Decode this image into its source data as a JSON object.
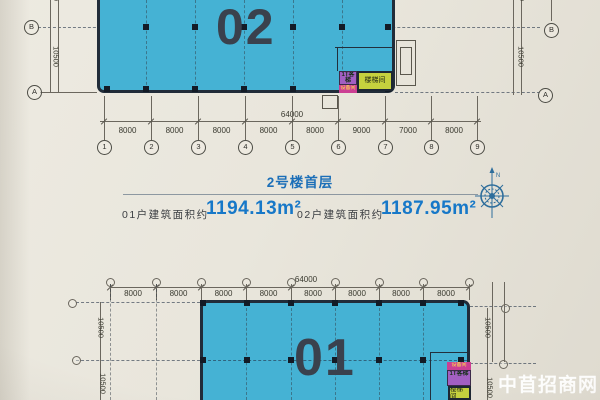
{
  "watermark": {
    "text": "中苜招商网"
  },
  "info": {
    "title": "2号楼首层",
    "areas": [
      {
        "label": "01户建筑面积约",
        "value": "1194.13m²"
      },
      {
        "label": "02户建筑面积约",
        "value": "1187.95m²"
      }
    ]
  },
  "compass": {
    "north_label": "N"
  },
  "plan_top": {
    "unit_label": "02",
    "total_dim": "64000",
    "segment_dims": [
      "8000",
      "8000",
      "8000",
      "8000",
      "8000",
      "9000",
      "7000",
      "8000"
    ],
    "grid_bubbles": [
      "1",
      "2",
      "3",
      "4",
      "5",
      "6",
      "7",
      "8",
      "9"
    ],
    "row_bubbles_left": [
      "B",
      "A"
    ],
    "row_bubbles_right": [
      "B",
      "A"
    ],
    "side_dim_left": "10500",
    "side_dim_left_upper": "10500",
    "side_dim_right": "10500",
    "side_dim_right_upper": "10500",
    "stair_label": "楼梯间",
    "elevator_label": "1T客梯",
    "equipment_label": "设备间"
  },
  "plan_bottom": {
    "unit_label": "01",
    "total_dim": "64000",
    "segment_dims": [
      "8000",
      "8000",
      "8000",
      "8000",
      "8000",
      "8000",
      "8000",
      "8000"
    ],
    "side_dims_left": [
      "10500",
      "10500"
    ],
    "side_dims_right": [
      "10500",
      "10500"
    ],
    "stair_label": "楼梯间",
    "elevator_label": "1T客梯",
    "equipment_label": "设备间"
  }
}
